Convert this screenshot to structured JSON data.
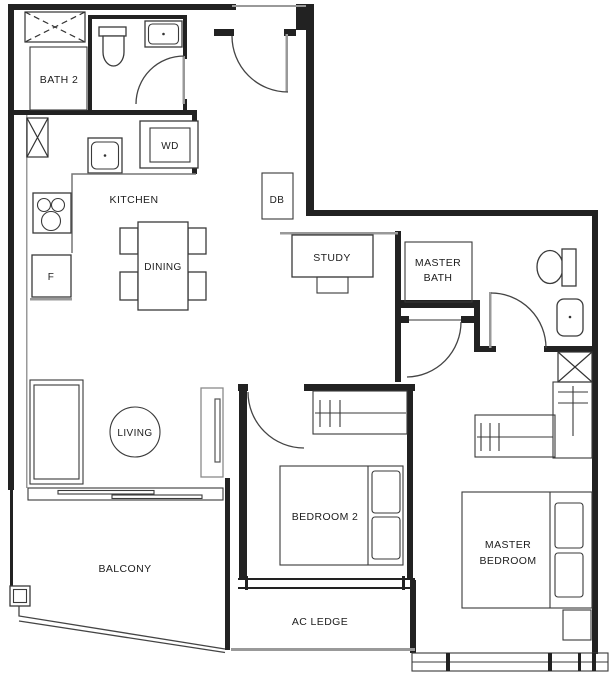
{
  "labels": {
    "bath2": "BATH 2",
    "wd": "WD",
    "kitchen": "KITCHEN",
    "dining": "DINING",
    "fridge": "F",
    "db": "DB",
    "study": "STUDY",
    "master_bath_line1": "MASTER",
    "master_bath_line2": "BATH",
    "living": "LIVING",
    "bedroom2": "BEDROOM 2",
    "master_bedroom_line1": "MASTER",
    "master_bedroom_line2": "BEDROOM",
    "balcony": "BALCONY",
    "ac_ledge": "AC LEDGE"
  },
  "colors": {
    "wall": "#222222",
    "line": "#444444",
    "light_line": "#999999",
    "background": "#ffffff",
    "text": "#1c1c1c"
  },
  "legend": {
    "hatched_box": "service-shaft",
    "arc": "door-swing",
    "double_band": "window",
    "offset_band": "sliding-door",
    "rod_with_ticks": "wardrobe-hangers"
  }
}
